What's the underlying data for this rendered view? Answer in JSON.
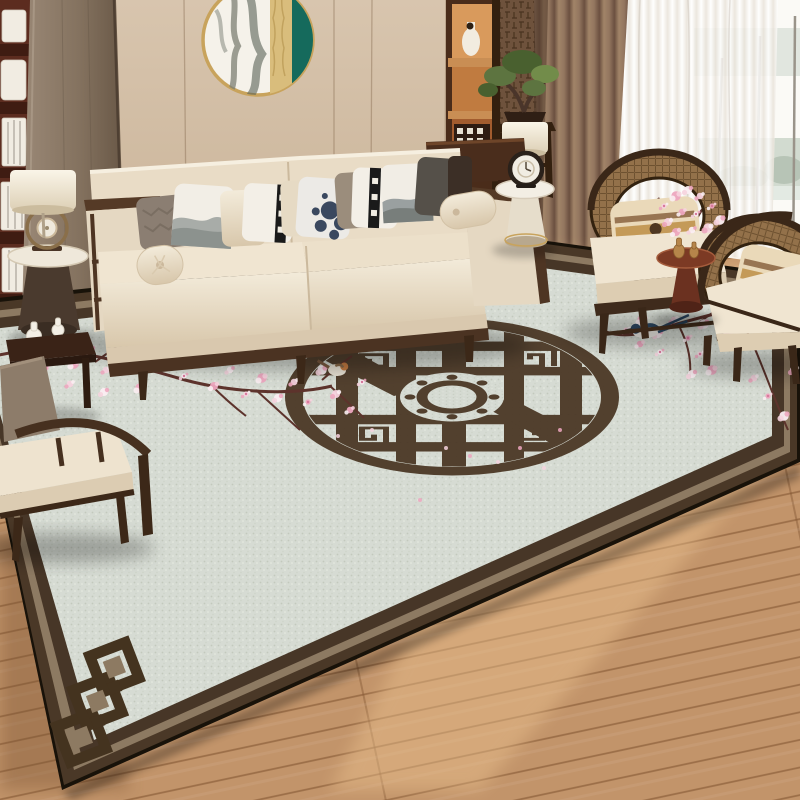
{
  "scene": {
    "kind": "photograph",
    "subject": "chinese-style living room with lattice medallion area rug",
    "objects": [
      "wall-panels",
      "round-wall-art",
      "left-bookshelf",
      "wood-column",
      "right-display-shelf",
      "fret-wallpaper",
      "bonsai-plant",
      "plant-stand",
      "table-lamp-right",
      "brown-curtain",
      "sheer-curtain",
      "window",
      "wood-floor",
      "area-rug",
      "rug-border",
      "rug-corner-motif",
      "rug-medallion",
      "cherry-blossom-branches",
      "birds",
      "cream-sofa",
      "throw-pillows",
      "bolster-cushions",
      "console-table",
      "white-side-table",
      "clock-ornament",
      "left-lamp-table",
      "ring-ornament",
      "left-armchair",
      "left-side-table",
      "mini-vases",
      "rattan-armchair-1",
      "rattan-armchair-2",
      "red-pedestal-table",
      "gold-vases",
      "vase-blossoms"
    ]
  },
  "palette": {
    "wall": "#d8c5ae",
    "wall2": "#c7b094",
    "floor": "#c2946a",
    "floor-light": "#ecc28f",
    "rug-field": "#d6dbd3",
    "rug-dark": "#4a3827",
    "rug-taupe": "#8d7a62",
    "rug-edge": "#181209",
    "medallion": "#4d3a28",
    "sofa-hi": "#f3ebda",
    "sofa-lo": "#d8c7ab",
    "wood": "#503823",
    "wood-dark": "#35231a",
    "shelf-red": "#5c2c1f",
    "curtain-a": "#93765f",
    "curtain-b": "#6b5040",
    "teal": "#156a5c",
    "gold": "#c8a35c",
    "red-table": "#7c3a24",
    "branch": "#5d332c",
    "rattan": "#93714a"
  },
  "blossoms": {
    "colors": [
      "#f6d3de",
      "#eda7bf",
      "#fbeef2",
      "#d8799c"
    ],
    "left": [
      [
        58,
        352
      ],
      [
        74,
        364
      ],
      [
        90,
        350
      ],
      [
        106,
        370
      ],
      [
        122,
        354
      ],
      [
        138,
        344
      ],
      [
        152,
        366
      ],
      [
        168,
        352
      ],
      [
        184,
        376
      ],
      [
        200,
        360
      ],
      [
        214,
        386
      ],
      [
        230,
        370
      ],
      [
        246,
        394
      ],
      [
        262,
        378
      ],
      [
        278,
        398
      ],
      [
        294,
        382
      ],
      [
        308,
        402
      ],
      [
        322,
        370
      ],
      [
        336,
        394
      ],
      [
        350,
        410
      ],
      [
        362,
        382
      ],
      [
        300,
        354
      ],
      [
        256,
        344
      ],
      [
        210,
        342
      ],
      [
        176,
        336
      ],
      [
        140,
        388
      ],
      [
        104,
        392
      ],
      [
        70,
        384
      ],
      [
        46,
        368
      ]
    ],
    "right": [
      [
        626,
        330
      ],
      [
        642,
        320
      ],
      [
        658,
        334
      ],
      [
        674,
        320
      ],
      [
        688,
        338
      ],
      [
        704,
        324
      ],
      [
        718,
        310
      ],
      [
        734,
        300
      ],
      [
        748,
        316
      ],
      [
        762,
        304
      ],
      [
        776,
        294
      ],
      [
        790,
        306
      ],
      [
        700,
        354
      ],
      [
        712,
        370
      ],
      [
        692,
        374
      ],
      [
        754,
        378
      ],
      [
        768,
        396
      ],
      [
        784,
        416
      ],
      [
        794,
        370
      ],
      [
        640,
        344
      ],
      [
        660,
        352
      ],
      [
        730,
        330
      ]
    ],
    "vase": [
      [
        664,
        206
      ],
      [
        676,
        196
      ],
      [
        688,
        190
      ],
      [
        700,
        196
      ],
      [
        712,
        206
      ],
      [
        720,
        220
      ],
      [
        668,
        222
      ],
      [
        682,
        212
      ],
      [
        696,
        214
      ],
      [
        708,
        228
      ],
      [
        676,
        232
      ],
      [
        692,
        230
      ]
    ],
    "petals": [
      [
        446,
        448
      ],
      [
        470,
        456
      ],
      [
        498,
        462
      ],
      [
        520,
        448
      ],
      [
        544,
        468
      ],
      [
        420,
        500
      ],
      [
        372,
        430
      ],
      [
        560,
        430
      ],
      [
        338,
        436
      ]
    ]
  },
  "birds": [
    {
      "name": "green-warbler",
      "transform": "translate(455,316) rotate(-6)"
    },
    {
      "name": "blue-magpie",
      "transform": "translate(646,332) rotate(-4)"
    },
    {
      "name": "orange-finch",
      "transform": "translate(337,370) rotate(4)"
    }
  ]
}
